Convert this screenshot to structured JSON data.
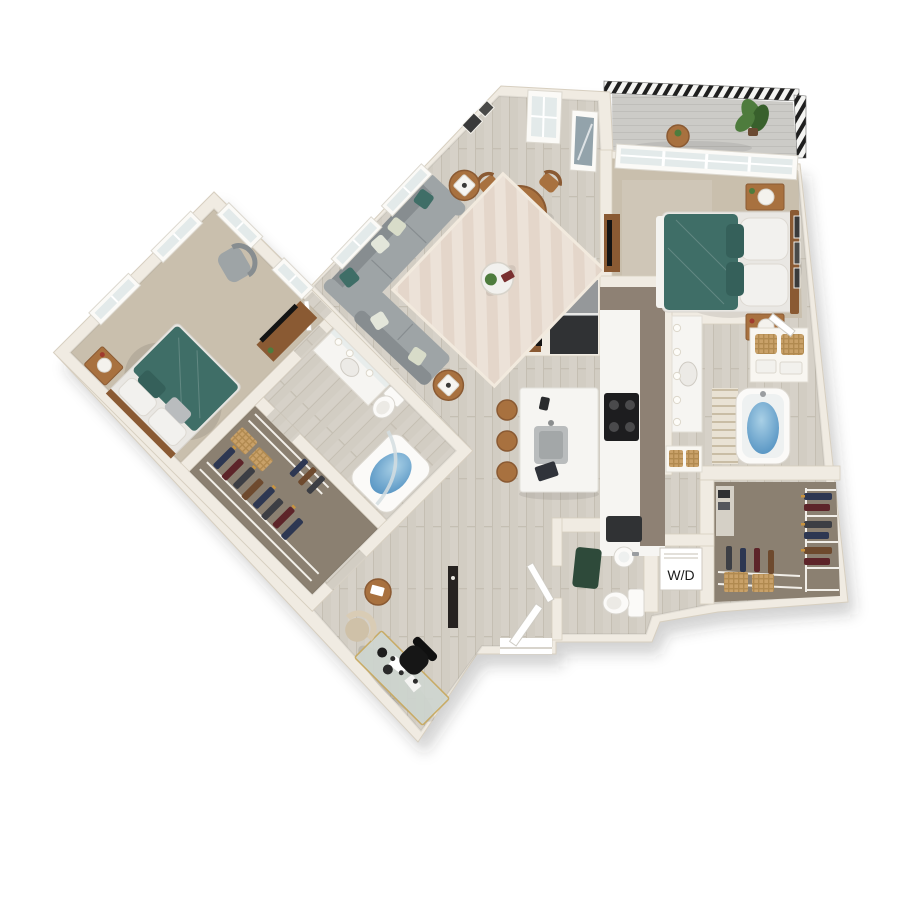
{
  "scene": {
    "kind": "3d-floor-plan-top-view",
    "background": "#ffffff",
    "rooms": [
      {
        "id": "living-room",
        "features": [
          "l-shaped-sectional-sofa",
          "teal-accent-pillows",
          "chevron-area-rug",
          "round-coffee-table",
          "two-wood-side-tables",
          "cube-lamps",
          "tv-console"
        ]
      },
      {
        "id": "dining-area",
        "features": [
          "round-wood-table",
          "four-wood-chairs",
          "centerpiece-plant",
          "white-sideboard",
          "wall-art",
          "tall-window",
          "balcony-glass-door"
        ]
      },
      {
        "id": "kitchen",
        "features": [
          "l-shaped-counter",
          "taupe-cabinets",
          "white-countertop",
          "black-cooktop",
          "refrigerator",
          "dishwasher",
          "white-island-with-sink",
          "three-round-wood-stools"
        ]
      },
      {
        "id": "master-bedroom",
        "features": [
          "bed-teal-duvet",
          "white-pillows",
          "two-nightstands",
          "white-lamps",
          "dresser-with-tv",
          "wall-art-frames",
          "transom-window-band",
          "carpet"
        ]
      },
      {
        "id": "master-bathroom",
        "features": [
          "vanity-with-mirror-lights",
          "soaking-tub-with-water",
          "striped-shower-curtain",
          "linen-shelves-with-baskets"
        ]
      },
      {
        "id": "master-walk-in-closet",
        "features": [
          "wire-shelving",
          "hanging-clothes",
          "woven-baskets",
          "dark-carpet"
        ]
      },
      {
        "id": "laundry-closet",
        "features": [
          "stacked-washer-dryer-box"
        ]
      },
      {
        "id": "powder-room",
        "features": [
          "toilet",
          "pedestal-sink",
          "green-bath-mat",
          "white-door"
        ]
      },
      {
        "id": "second-bedroom",
        "features": [
          "bed-teal-duvet",
          "gray-armchair",
          "nightstand-with-lamp",
          "dresser-with-tv",
          "windows-two-walls",
          "carpet"
        ]
      },
      {
        "id": "second-bathroom",
        "features": [
          "vanity-with-mirror-lights",
          "toilet",
          "tub-with-curved-glass",
          "water"
        ]
      },
      {
        "id": "second-walk-in-closet",
        "features": [
          "wire-shelving",
          "hanging-clothes",
          "woven-baskets",
          "dark-carpet"
        ]
      },
      {
        "id": "den-office",
        "features": [
          "glass-desk-gold-frame",
          "black-office-chair",
          "beige-armchair",
          "round-side-table"
        ]
      },
      {
        "id": "entry",
        "features": [
          "front-door-ajar",
          "dark-console"
        ]
      },
      {
        "id": "balcony",
        "features": [
          "plank-decking",
          "black-metal-railing",
          "potted-plant",
          "round-bistro-table"
        ]
      }
    ]
  },
  "labels": {
    "washer_dryer": "W/D"
  },
  "palette": {
    "wall": "#f0ebe2",
    "wall_edge": "#d7cfc0",
    "wood_a": "#d6d1c8",
    "wood_line": "#c5bfb3",
    "carpet_bed": "#c9bfad",
    "carpet_closet": "#8b8071",
    "counter": "#f6f5f2",
    "cabinet": "#8e8174",
    "steel": "#95989a",
    "appliance_dark": "#303234",
    "teal": "#3f6e67",
    "teal_dark": "#35605a",
    "sofa": "#9ea4a6",
    "sofa_dark": "#878d90",
    "rug_a": "#ece2d8",
    "rug_b": "#ddccbf",
    "wood_furn": "#a8713f",
    "wood_furn_dark": "#8a5a33",
    "water_a": "#a9d0e6",
    "water_b": "#4f8fc0",
    "plant": "#4e7c3d",
    "plant_dark": "#38602c",
    "mat_green": "#2e4a3a",
    "basket_a": "#c9a169",
    "basket_b": "#b18a50",
    "glass": "#e3eaea",
    "glass_dark": "#93a3ab",
    "deck_a": "#cccbc7",
    "deck_b": "#bfbeba",
    "railing": "#1f1f1f",
    "ink": "#1c1c1c",
    "paper": "#ffffff"
  }
}
